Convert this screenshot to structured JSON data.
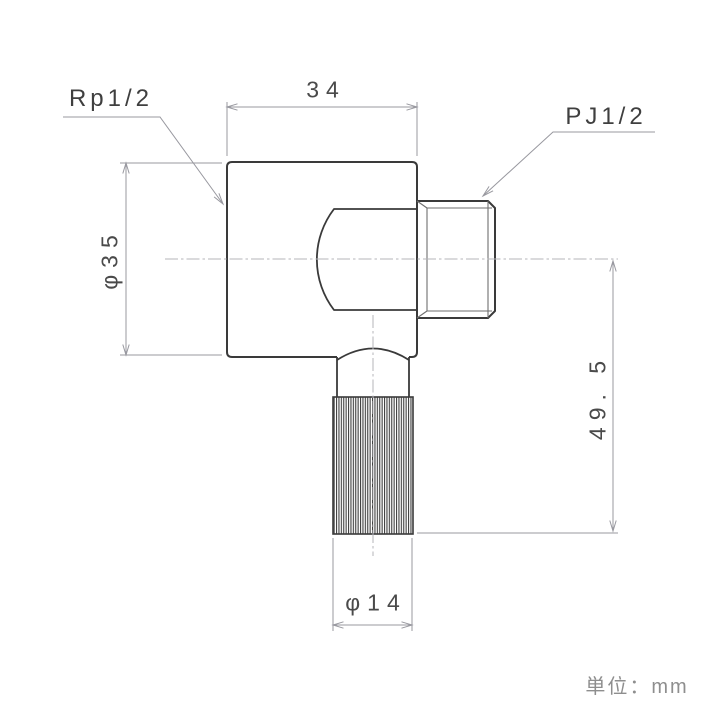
{
  "drawing": {
    "type": "technical-drawing",
    "part": "right-angle pipe fitting elbow",
    "unit_note": "単位：mm",
    "labels": {
      "left_thread": "Rp1/2",
      "right_thread": "PJ1/2"
    },
    "dimensions": {
      "top_width": "34",
      "left_diameter": "φ35",
      "right_height": "49. 5",
      "bottom_diameter": "φ14"
    },
    "colors": {
      "object_line": "#3a3a3a",
      "thin_line": "#6e6e6e",
      "dimension_line": "#98989f",
      "centerline": "#b4b4ba",
      "dim_text": "#4a4a4a",
      "unit_text": "#8e8e8e",
      "background": "#ffffff"
    }
  }
}
